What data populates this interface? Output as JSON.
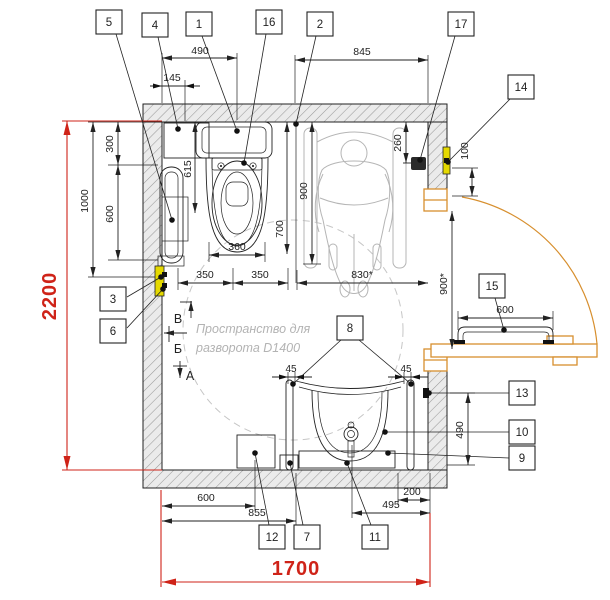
{
  "drawing_type": "accessible-wc-floor-plan",
  "note": {
    "line1": "Пространство для",
    "line2": "разворота D1400"
  },
  "red_dims": {
    "height": "2200",
    "width": "1700"
  },
  "sections": {
    "v": "В",
    "b": "Б",
    "a": "А"
  },
  "callouts": {
    "c1": "1",
    "c2": "2",
    "c3": "3",
    "c4": "4",
    "c5": "5",
    "c6": "6",
    "c7": "7",
    "c8": "8",
    "c9": "9",
    "c10": "10",
    "c11": "11",
    "c12": "12",
    "c13": "13",
    "c14": "14",
    "c15": "15",
    "c16": "16",
    "c17": "17"
  },
  "dims": {
    "d145": "145",
    "d490": "490",
    "d845": "845",
    "d300": "300",
    "d600_left": "600",
    "d1000": "1000",
    "d615": "615",
    "d700": "700",
    "d900_in": "900",
    "d260": "260",
    "d360": "360",
    "d350a": "350",
    "d350b": "350",
    "d830": "830*",
    "d100": "100",
    "d900_door": "900*",
    "d490_right": "490",
    "d600_door": "600",
    "d45a": "45",
    "d45b": "45",
    "d600_bottom": "600",
    "d855": "855",
    "d495": "495",
    "d200": "200"
  },
  "colors": {
    "dimension_red": "#cf2318",
    "door_orange": "#d78f2e",
    "alarm_yellow": "#e5d900",
    "figure_gray": "#b5b5b5",
    "note_gray": "#b3b3b3",
    "line_black": "#222222"
  }
}
